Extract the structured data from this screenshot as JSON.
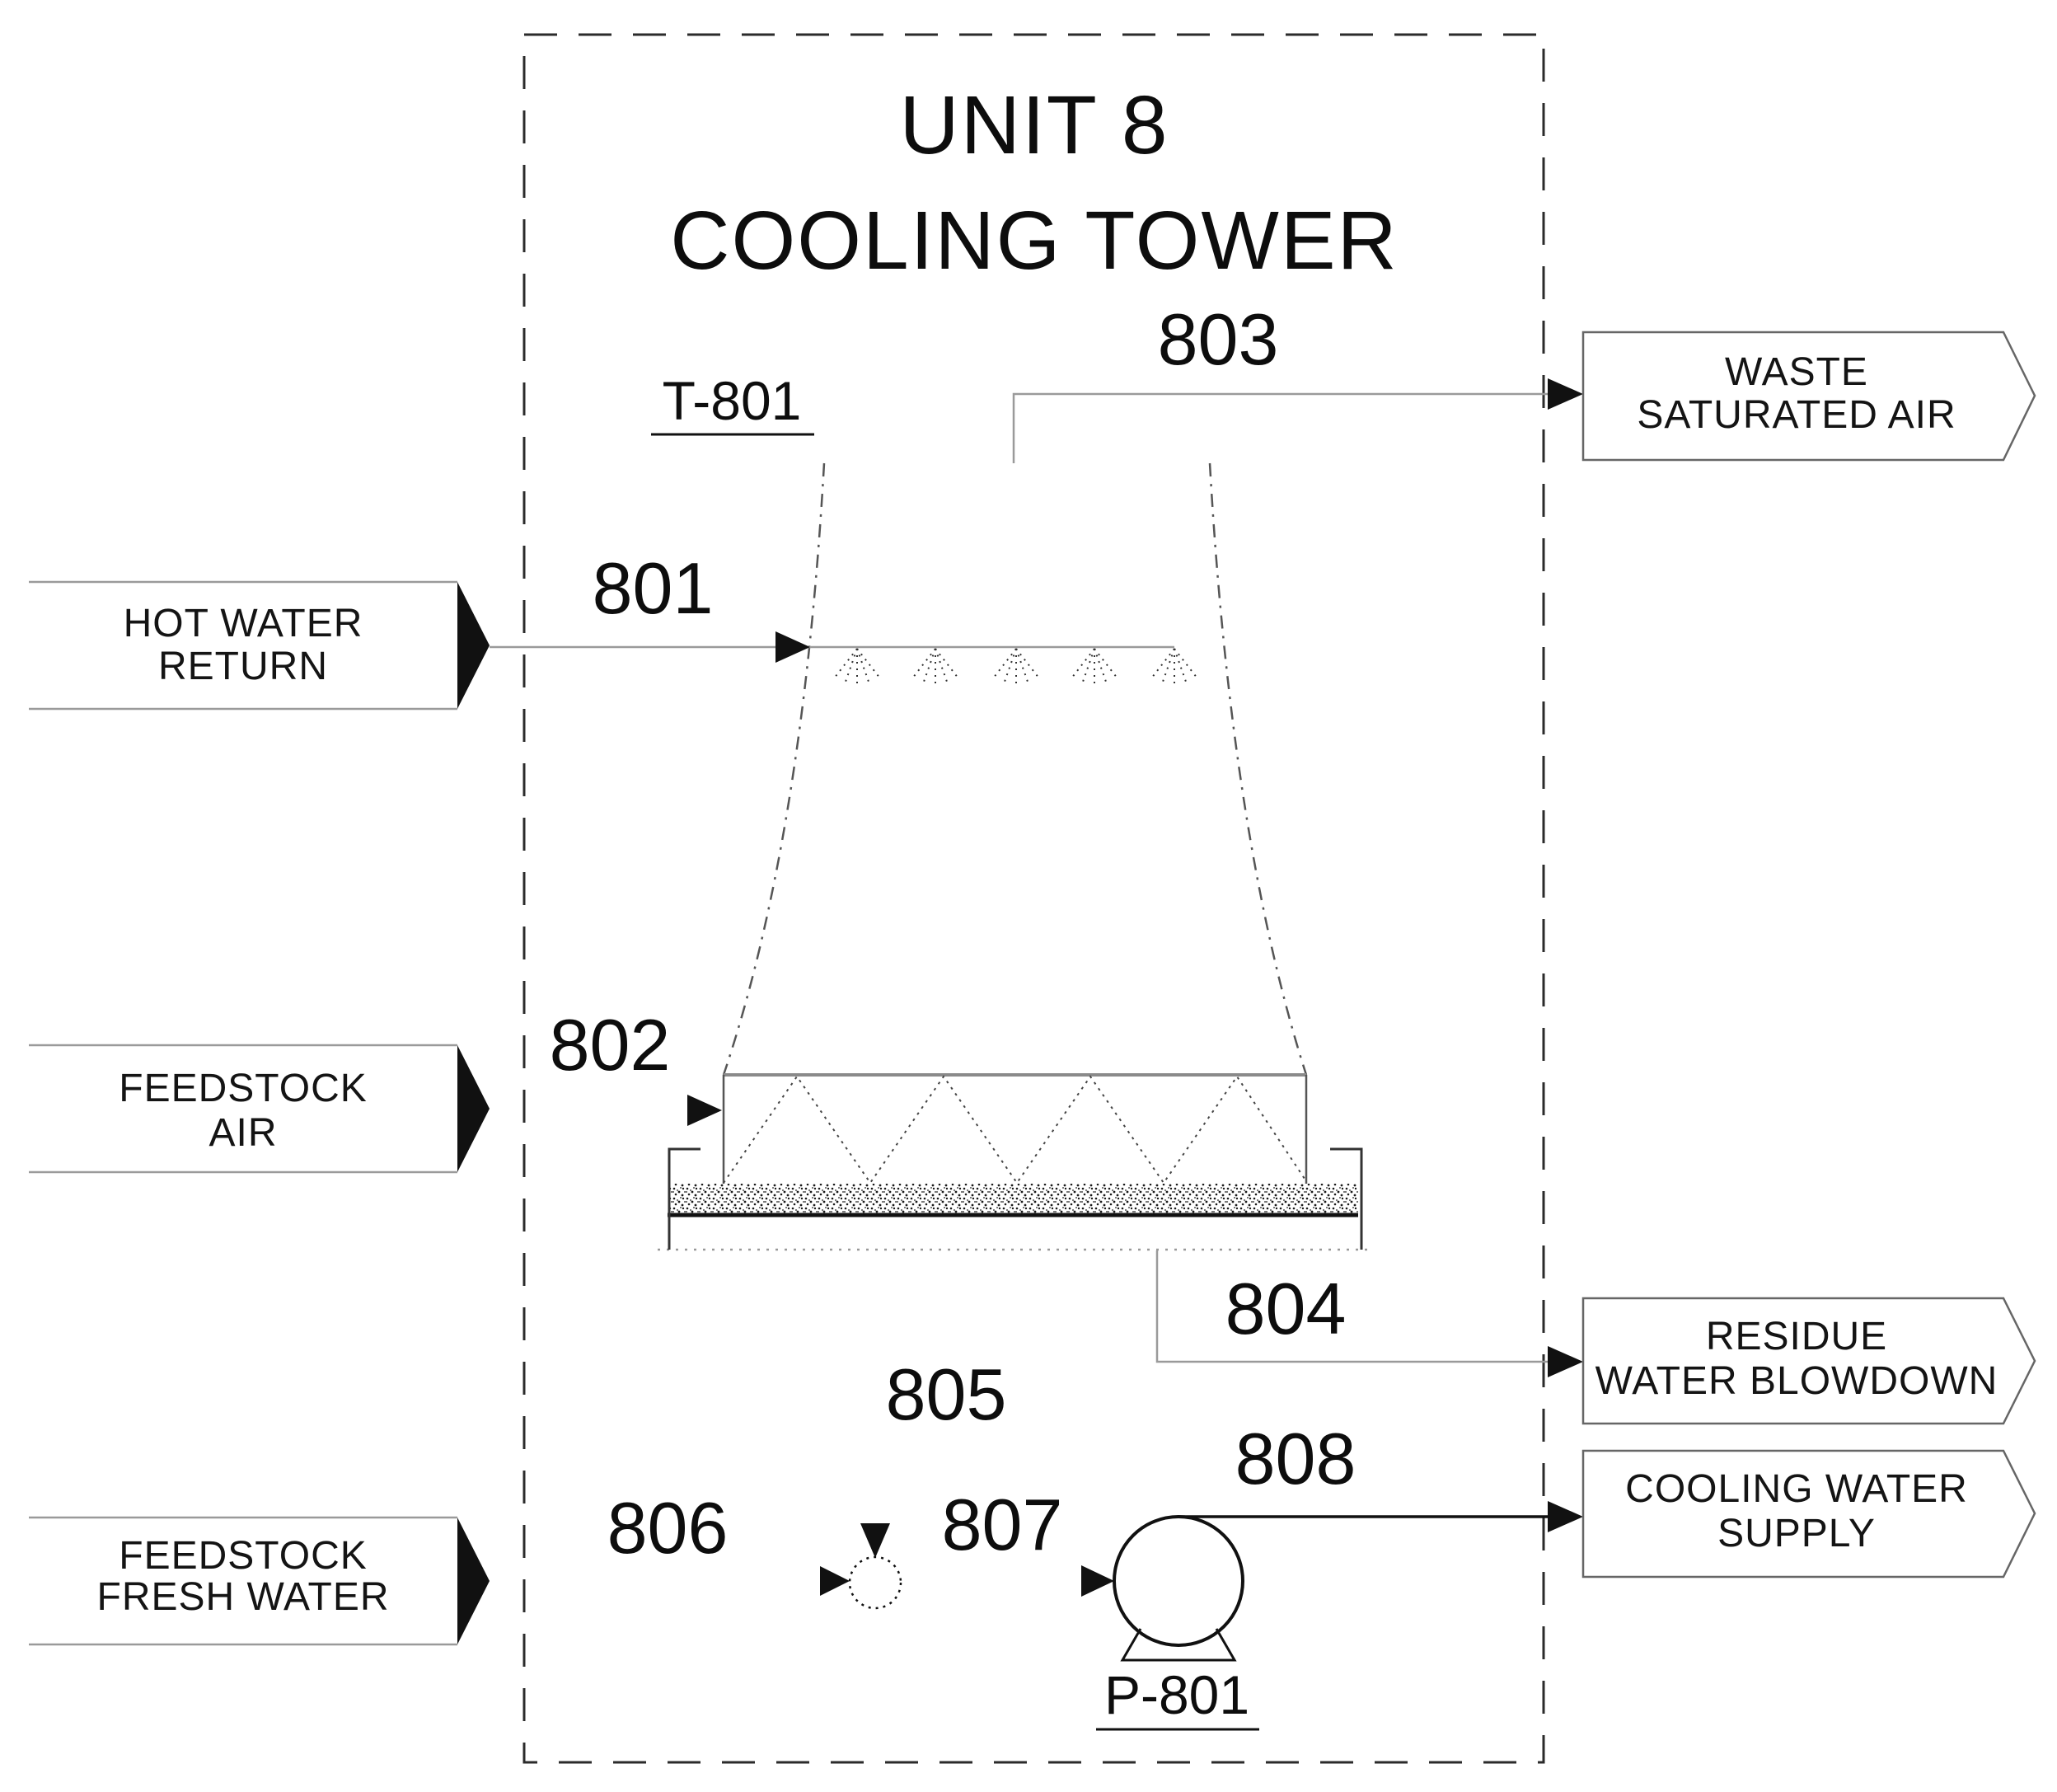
{
  "title": {
    "line1": "UNIT 8",
    "line2": "COOLING TOWER"
  },
  "equipment": {
    "cooling_tower_tag": "T-801",
    "pump_tag": "P-801"
  },
  "streams": {
    "801": "801",
    "802": "802",
    "803": "803",
    "804": "804",
    "805": "805",
    "806": "806",
    "807": "807",
    "808": "808"
  },
  "inputs": [
    {
      "id": "hot-water-return",
      "line1": "HOT WATER",
      "line2": "RETURN"
    },
    {
      "id": "feedstock-air",
      "line1": "FEEDSTOCK",
      "line2": "AIR"
    },
    {
      "id": "feedstock-fresh-water",
      "line1": "FEEDSTOCK",
      "line2": "FRESH WATER"
    }
  ],
  "outputs": [
    {
      "id": "waste-saturated-air",
      "line1": "WASTE",
      "line2": "SATURATED AIR"
    },
    {
      "id": "residue-water-blowdown",
      "line1": "RESIDUE",
      "line2": "WATER BLOWDOWN"
    },
    {
      "id": "cooling-water-supply",
      "line1": "COOLING WATER",
      "line2": "SUPPLY"
    }
  ],
  "colors": {
    "ink": "#111111",
    "thin_line_gray": "#9a9a9a",
    "boundary_dash": "#2b2b2b"
  }
}
